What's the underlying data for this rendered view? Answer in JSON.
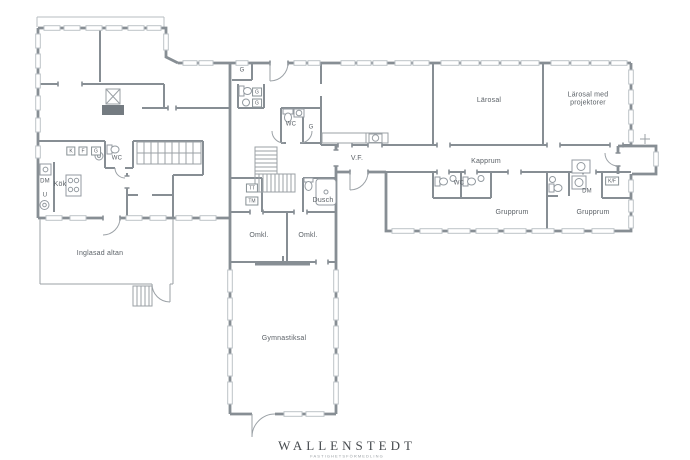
{
  "floorplan": {
    "rooms": {
      "larosal": "Lärosal",
      "larosal_projektorer": "Lärosal med projektorer",
      "kapprum": "Kapprum",
      "grupprum_left": "Grupprum",
      "grupprum_right": "Grupprum",
      "vf": "V.F.",
      "kok": "Kök",
      "inglasad_altan": "Inglasad altan",
      "gymnastiksal": "Gymnastiksal",
      "dusch": "Dusch",
      "omkl_left": "Omkl.",
      "omkl_right": "Omkl."
    },
    "labels": {
      "wc_center": "WC",
      "wc_kitchen": "WC",
      "wc_group": "WC",
      "g_room": "G",
      "g_closet": "G",
      "g_cab_1": "G",
      "g_cab_2": "G",
      "k": "K",
      "f": "F",
      "g_kitchen": "G",
      "kf": "K/F",
      "dm_kitchen": "DM",
      "dm_group": "DM",
      "u": "U",
      "tt": "TT",
      "tm": "TM"
    },
    "logo": {
      "name": "WALLENSTEDT",
      "tagline": "FASTIGHETSFÖRMEDLING"
    },
    "colors": {
      "wall": "#878e94",
      "window": "#bdc3c7",
      "detail": "#9ba1a6",
      "hearth": "#747b81"
    }
  }
}
